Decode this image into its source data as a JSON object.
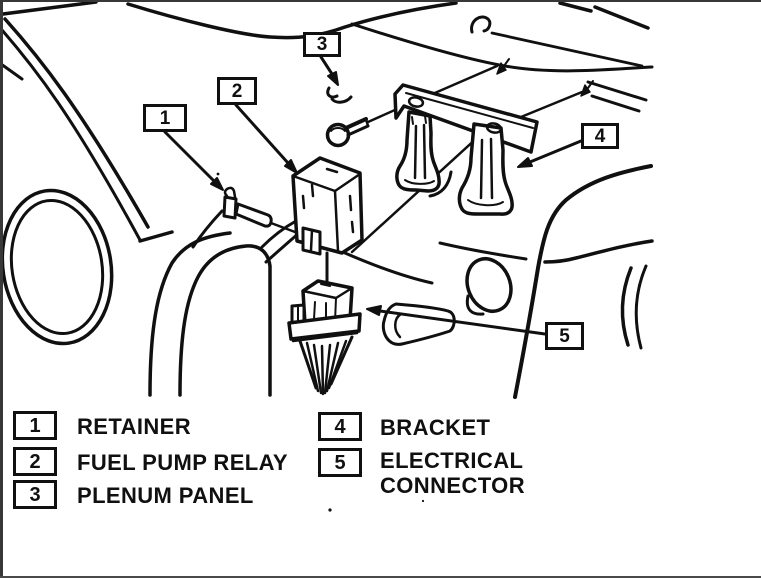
{
  "colors": {
    "ink": "#101010",
    "paper": "#ffffff",
    "frame": "#383838"
  },
  "diagram": {
    "callouts": [
      {
        "num": "1"
      },
      {
        "num": "2"
      },
      {
        "num": "3"
      },
      {
        "num": "4"
      },
      {
        "num": "5"
      }
    ]
  },
  "legend": {
    "columns": [
      {
        "items": [
          {
            "num": "1",
            "label": "RETAINER"
          },
          {
            "num": "2",
            "label": "FUEL PUMP RELAY"
          },
          {
            "num": "3",
            "label": "PLENUM PANEL"
          }
        ]
      },
      {
        "items": [
          {
            "num": "4",
            "label": "BRACKET"
          },
          {
            "num": "5",
            "label": "ELECTRICAL CONNECTOR"
          }
        ]
      }
    ]
  }
}
